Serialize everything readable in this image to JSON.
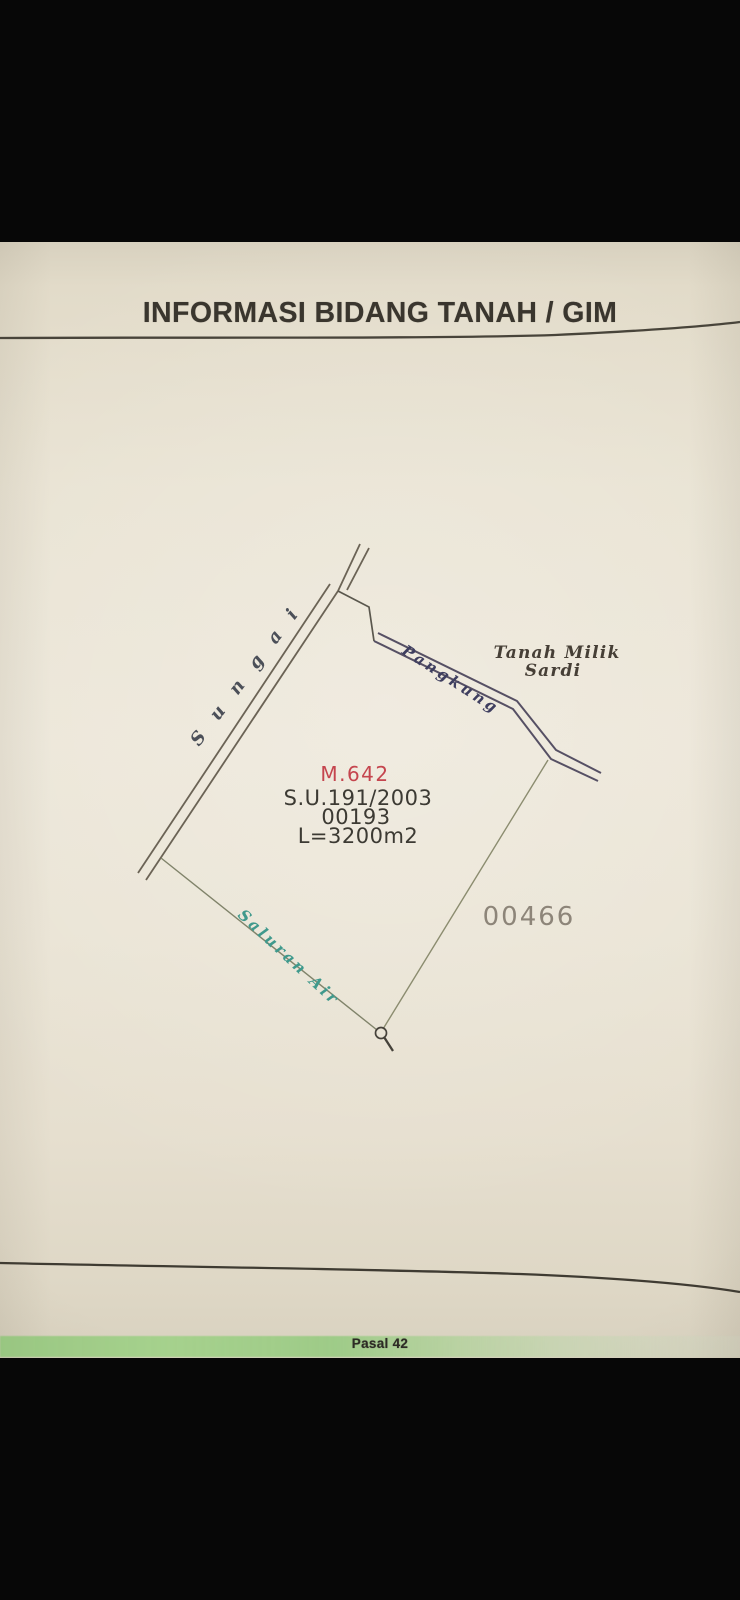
{
  "document": {
    "title": "INFORMASI BIDANG TANAH / GIM",
    "footer_note": "Pasal 42"
  },
  "parcel": {
    "id": "M.642",
    "surat_ukur": "S.U.191/2003",
    "nib": "00193",
    "area": "L=3200m2"
  },
  "labels": {
    "river": "Sungai",
    "ravine": "Pangkung",
    "waterway": "Saluran Air",
    "neighbor_parcel": "00466",
    "adjacent_owner_line1": "Tanah Milik",
    "adjacent_owner_line2": "Sardi"
  },
  "colors": {
    "parcel_id_red": "#c5454e",
    "ravine_ink_blue": "#3e3e5f",
    "waterway_teal": "#3f998c",
    "highlight_green": "#98cb82",
    "paper_beige": "#e9e3d3",
    "ink_dark": "#3c3a33"
  }
}
